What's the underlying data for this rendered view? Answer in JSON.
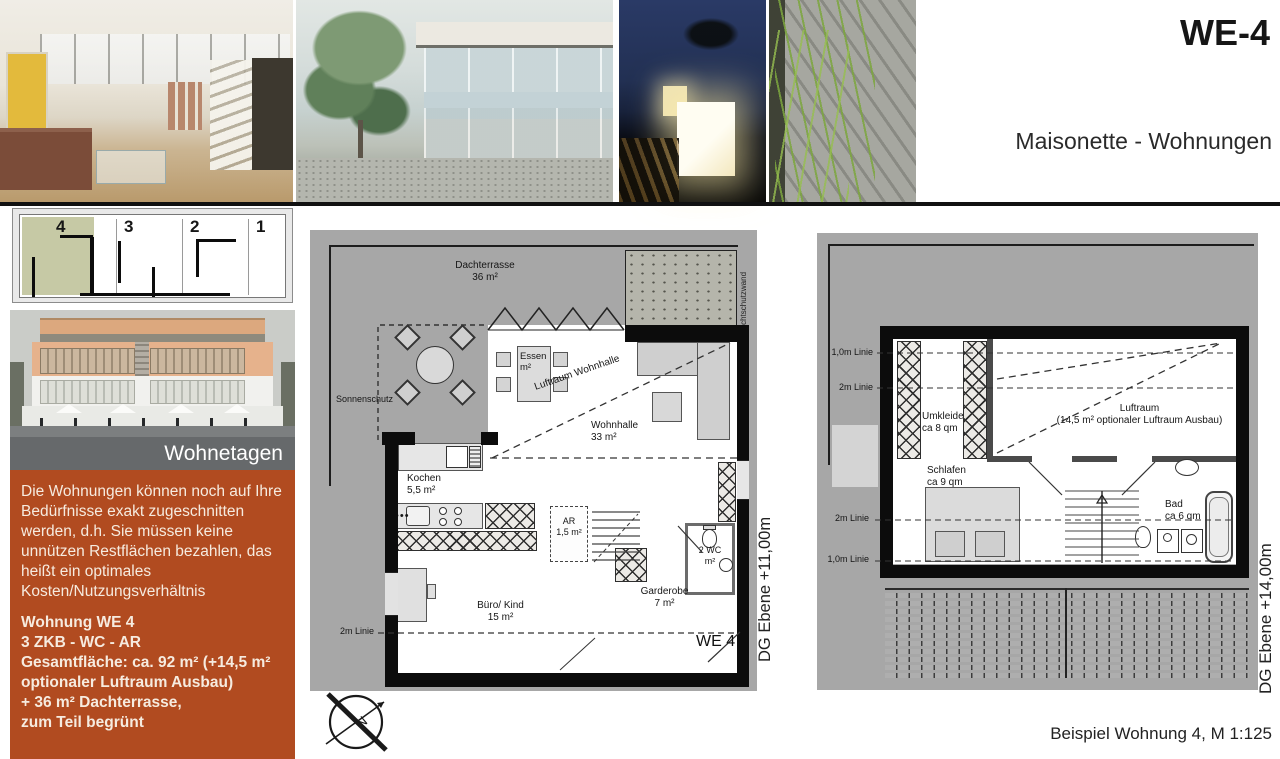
{
  "header": {
    "code": "WE-4",
    "subtitle": "Maisonette - Wohnungen"
  },
  "sidebar": {
    "overview": {
      "unit4": "4",
      "unit3": "3",
      "unit2": "2",
      "unit1": "1"
    },
    "band_label": "Wohnetagen",
    "paragraph": "Die Wohnungen können noch auf Ihre Bedürfnisse exakt zugeschnitten werden, d.h. Sie müssen keine unnützen Restflächen bezahlen, das heißt ein optimales Kosten/Nutzungsverhältnis",
    "unit": {
      "title": "Wohnung WE 4",
      "rooms": "3 ZKB - WC - AR",
      "area": "Gesamtfläche: ca. 92 m² (+14,5 m² optionaler Luftraum Ausbau)",
      "terrace": "+ 36 m² Dachterrasse,",
      "green": "zum Teil begrünt"
    }
  },
  "plan_lower": {
    "dachterrasse": "Dachterrasse",
    "dachterrasse_area": "36 m²",
    "sonnenschutz": "Sonnenschutz",
    "sichtschutzwand": "Sichtschutzwand",
    "essen": "Essen",
    "essen_area": "m²",
    "luftraum_wohnhalle": "Luftraum Wohnhalle",
    "wohnhalle": "Wohnhalle",
    "wohnhalle_area": "33 m²",
    "kochen": "Kochen",
    "kochen_area": "5,5 m²",
    "ar": "AR",
    "ar_area": "1,5 m²",
    "wc": "2 WC",
    "wc_area": "m²",
    "buero": "Büro/ Kind",
    "buero_area": "15 m²",
    "garderobe": "Garderobe",
    "garderobe_area": "7 m²",
    "linie_2m": "2m Linie",
    "unit_tag": "WE 4",
    "level": "DG Ebene +11,00m"
  },
  "plan_upper": {
    "linie_1m_a": "1,0m Linie",
    "linie_2m_a": "2m Linie",
    "linie_2m_b": "2m Linie",
    "linie_1m_b": "1,0m Linie",
    "umkleide": "Umkleide",
    "umkleide_area": "ca 8 qm",
    "schlafen": "Schlafen",
    "schlafen_area": "ca 9 qm",
    "luftraum": "Luftraum",
    "luftraum_note": "(14,5 m² optionaler Luftraum Ausbau)",
    "bad": "Bad",
    "bad_area": "ca 6 qm",
    "level": "DG Ebene +14,00m"
  },
  "compass": {
    "north": "N"
  },
  "footer": {
    "caption": "Beispiel Wohnung 4, M 1:125"
  },
  "colors": {
    "accent_orange": "#b14b20",
    "band_gray": "#66696b",
    "plan_gray": "#a7a7a7",
    "highlight_olive": "#c6c9a5"
  }
}
